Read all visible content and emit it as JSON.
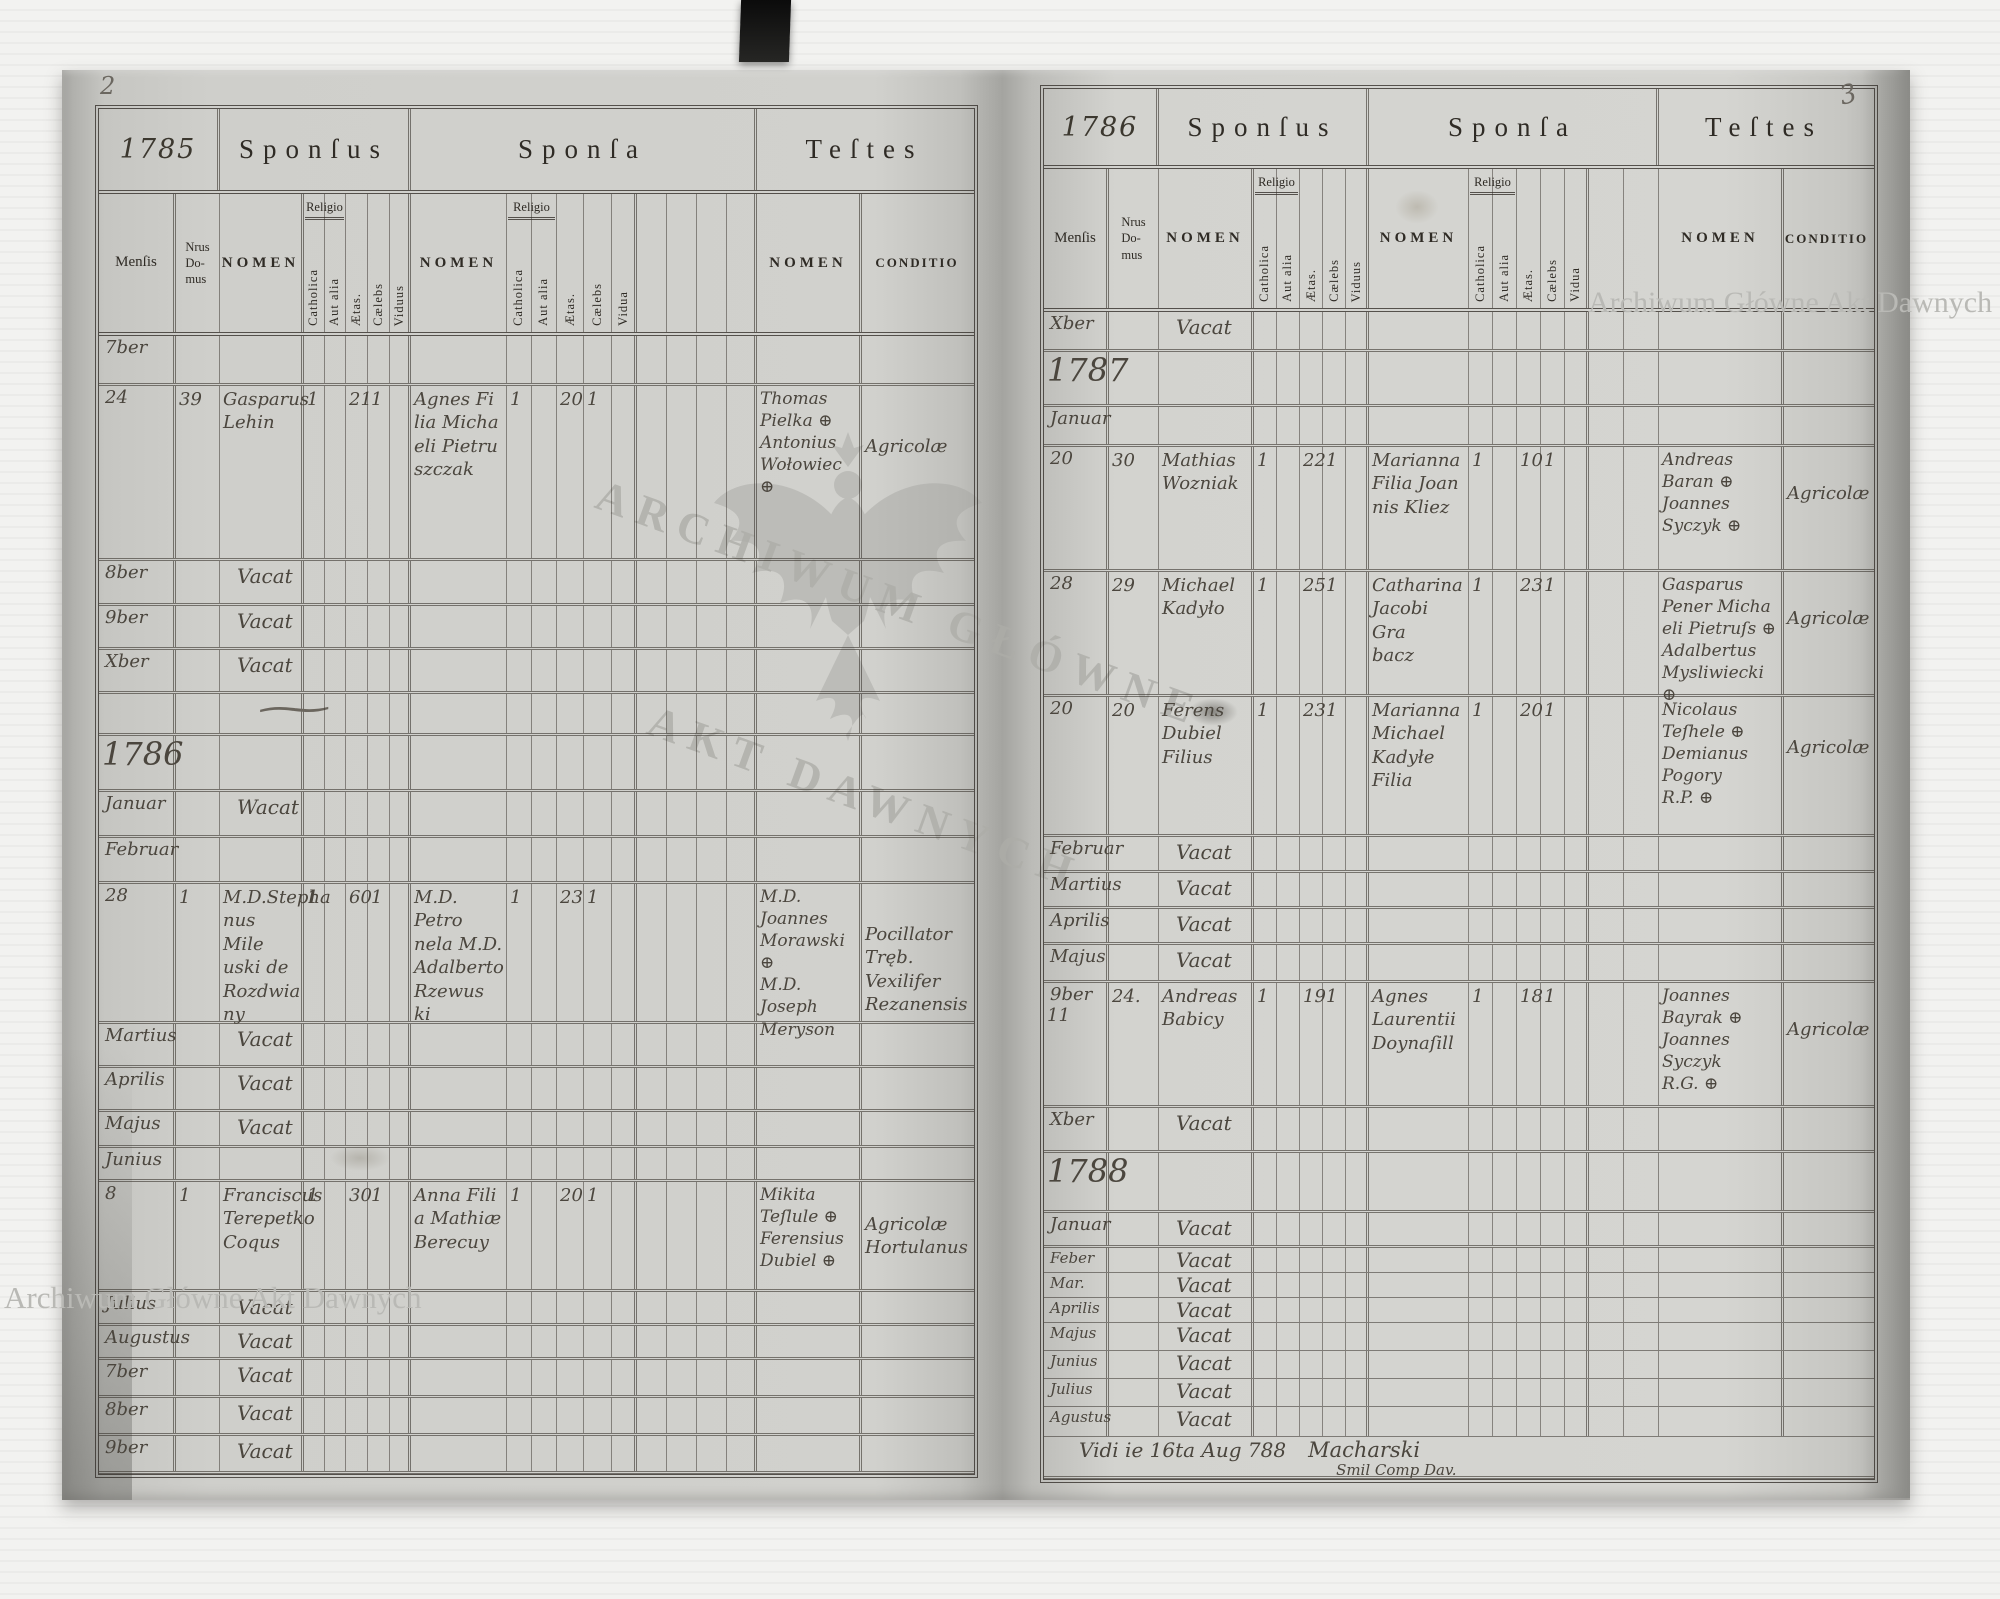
{
  "scan": {
    "archive_watermark": "Archiwum Główne Akt Dawnych",
    "stamp_line1": "ARCHIWUM GŁÓWNE",
    "stamp_line2": "AKT DAWNYCH",
    "paper_color": "#d1d1cd",
    "ink_color": "#4b463e"
  },
  "left_page": {
    "page_number": "2",
    "year_label": "1785",
    "headers": {
      "sponsus": "Sponſus",
      "sponsa": "Sponſa",
      "testes": "Teſtes"
    },
    "columns": {
      "mensis": "Menſis",
      "nrus_domus": "Nrus\nDo-\nmus",
      "nomen": "NOMEN",
      "conditio": "CONDITIO",
      "religio": "Religio",
      "sponsus_sub": [
        "Catholica",
        "Aut alia",
        "Ætas.",
        "Cælebs",
        "Viduus"
      ],
      "sponsa_sub": [
        "Catholica",
        "Aut alia",
        "Ætas.",
        "Cælebs",
        "Vidua"
      ]
    },
    "rows": [
      {
        "h": 50,
        "m": "7ber"
      },
      {
        "h": 175,
        "m": "24",
        "n": "39",
        "sn": "Gasparus\nLehin",
        "s": [
          "1",
          "",
          "21",
          "1",
          ""
        ],
        "an": "Agnes Fi\nlia Micha\neli Pietru\nszczak",
        "a": [
          "1",
          "",
          "20",
          "1",
          ""
        ],
        "tn": "Thomas\nPielka ⊕\nAntonius\nWołowiec\n⊕",
        "co": "Agricolæ"
      },
      {
        "h": 45,
        "m": "8ber",
        "v": "Vacat"
      },
      {
        "h": 44,
        "m": "9ber",
        "v": "Vacat"
      },
      {
        "h": 44,
        "m": "Xber",
        "v": "Vacat"
      },
      {
        "h": 42,
        "fl": "~"
      },
      {
        "h": 56,
        "y": "1786"
      },
      {
        "h": 46,
        "m": "Januar",
        "v": "Wacat"
      },
      {
        "h": 46,
        "m": "Februar"
      },
      {
        "h": 140,
        "m": "28",
        "n": "1",
        "sn": "M.D.Stepha\nnus Mile\nuski de\nRozdwia\nny",
        "s": [
          "1",
          "",
          "60",
          "1",
          ""
        ],
        "an": "M.D. Petro\nnela M.D.\nAdalberto\nRzewus\nki",
        "a": [
          "1",
          "",
          "23",
          "1",
          ""
        ],
        "tn": "M.D. Joannes\nMorawski ⊕\nM.D. Joseph\nMeryson",
        "co": "Pocillator Tręb.\nVexilifer\nRezanensis"
      },
      {
        "h": 44,
        "m": "Martius",
        "v": "Vacat"
      },
      {
        "h": 44,
        "m": "Aprilis",
        "v": "Vacat"
      },
      {
        "h": 36,
        "m": "Majus",
        "v": "Vacat"
      },
      {
        "h": 34,
        "m": "Junius"
      },
      {
        "h": 110,
        "m": "8",
        "n": "1",
        "sn": "Franciscus\nTerepetko\nCoqus",
        "s": [
          "1",
          "",
          "30",
          "1",
          ""
        ],
        "an": "Anna Fili\na Mathiæ\nBerecuy",
        "a": [
          "1",
          "",
          "20",
          "1",
          ""
        ],
        "tn": "Mikita\nTeſlule ⊕\nFerensius\nDubiel ⊕",
        "co": "Agricolæ\nHortulanus"
      },
      {
        "h": 34,
        "m": "Julius",
        "v": "Vacat"
      },
      {
        "h": 34,
        "m": "Augustus",
        "v": "Vacat"
      },
      {
        "h": 38,
        "m": "7ber",
        "v": "Vacat"
      },
      {
        "h": 38,
        "m": "8ber",
        "v": "Vacat"
      },
      {
        "h": 38,
        "m": "9ber",
        "v": "Vacat"
      }
    ]
  },
  "right_page": {
    "page_number": "3",
    "year_label": "1786",
    "headers": {
      "sponsus": "Sponſus",
      "sponsa": "Sponſa",
      "testes": "Teſtes"
    },
    "columns": {
      "mensis": "Menſis",
      "nrus_domus": "Nrus\nDo-\nmus",
      "nomen": "NOMEN",
      "conditio": "CONDITIO",
      "religio": "Religio",
      "sponsus_sub": [
        "Catholica",
        "Aut alia",
        "Ætas.",
        "Cælebs",
        "Viduus"
      ],
      "sponsa_sub": [
        "Catholica",
        "Aut alia",
        "Ætas.",
        "Cælebs",
        "Vidua"
      ]
    },
    "note": {
      "prefix": "Vidi ie 16ta Aug 788",
      "signature": "Macharski",
      "sub": "Smil Comp Dav."
    },
    "rows": [
      {
        "h": 40,
        "m": "Xber",
        "v": "Vacat"
      },
      {
        "h": 55,
        "y": "1787"
      },
      {
        "h": 40,
        "m": "Januar"
      },
      {
        "h": 125,
        "m": "20",
        "n": "30",
        "sn": "Mathias\nWozniak",
        "s": [
          "1",
          "",
          "22",
          "1",
          ""
        ],
        "an": "Marianna\nFilia Joan\nnis Kliez",
        "a": [
          "1",
          "",
          "10",
          "1",
          ""
        ],
        "tn": "Andreas\nBaran ⊕\nJoannes\nSyczyk ⊕",
        "co": "Agricolæ"
      },
      {
        "h": 125,
        "m": "28",
        "n": "29",
        "sn": "Michael\nKadyło",
        "s": [
          "1",
          "",
          "25",
          "1",
          ""
        ],
        "an": "Catharina\nJacobi Gra\nbacz",
        "a": [
          "1",
          "",
          "23",
          "1",
          ""
        ],
        "tn": "Gasparus\nPener Micha\neli Pietruſs ⊕\nAdalbertus\nMysliwiecki ⊕",
        "co": "Agricolæ"
      },
      {
        "h": 140,
        "m": "20",
        "n": "20",
        "sn": "Ferens\nDubiel\nFilius",
        "s": [
          "1",
          "",
          "23",
          "1",
          ""
        ],
        "an": "Marianna\nMichael\nKadyłe Filia",
        "a": [
          "1",
          "",
          "20",
          "1",
          ""
        ],
        "tn": "Nicolaus\nTeſhele ⊕\nDemianus\nPogory\nR.P. ⊕",
        "co": "Agricolæ"
      },
      {
        "h": 36,
        "m": "Februar",
        "v": "Vacat"
      },
      {
        "h": 36,
        "m": "Martius",
        "v": "Vacat"
      },
      {
        "h": 36,
        "m": "Aprilis",
        "v": "Vacat"
      },
      {
        "h": 38,
        "m": "Majus",
        "v": "Vacat"
      },
      {
        "h": 125,
        "m": "9ber\n11",
        "n": "24.",
        "sn": "Andreas\nBabicy",
        "s": [
          "1",
          "",
          "19",
          "1",
          ""
        ],
        "an": "Agnes\nLaurentii\nDoynaſill",
        "a": [
          "1",
          "",
          "18",
          "1",
          ""
        ],
        "tn": "Joannes\nBayrak ⊕\nJoannes\nSyczyk\nR.G. ⊕",
        "co": "Agricolæ"
      },
      {
        "h": 45,
        "m": "Xber",
        "v": "Vacat"
      },
      {
        "h": 60,
        "y": "1788"
      },
      {
        "h": 35,
        "m": "Januar",
        "v": "Vacat"
      },
      {
        "h": 25,
        "m": "Feber",
        "v": "Vacat"
      },
      {
        "h": 25,
        "m": "Mar.",
        "v": "Vacat"
      },
      {
        "h": 25,
        "m": "Aprilis",
        "v": "Vacat"
      },
      {
        "h": 28,
        "m": "Majus",
        "v": "Vacat"
      },
      {
        "h": 28,
        "m": "Junius",
        "v": "Vacat"
      },
      {
        "h": 28,
        "m": "Julius",
        "v": "Vacat"
      },
      {
        "h": 30,
        "m": "Agustus",
        "v": "Vacat"
      },
      {
        "h": 42,
        "note": true
      }
    ]
  }
}
